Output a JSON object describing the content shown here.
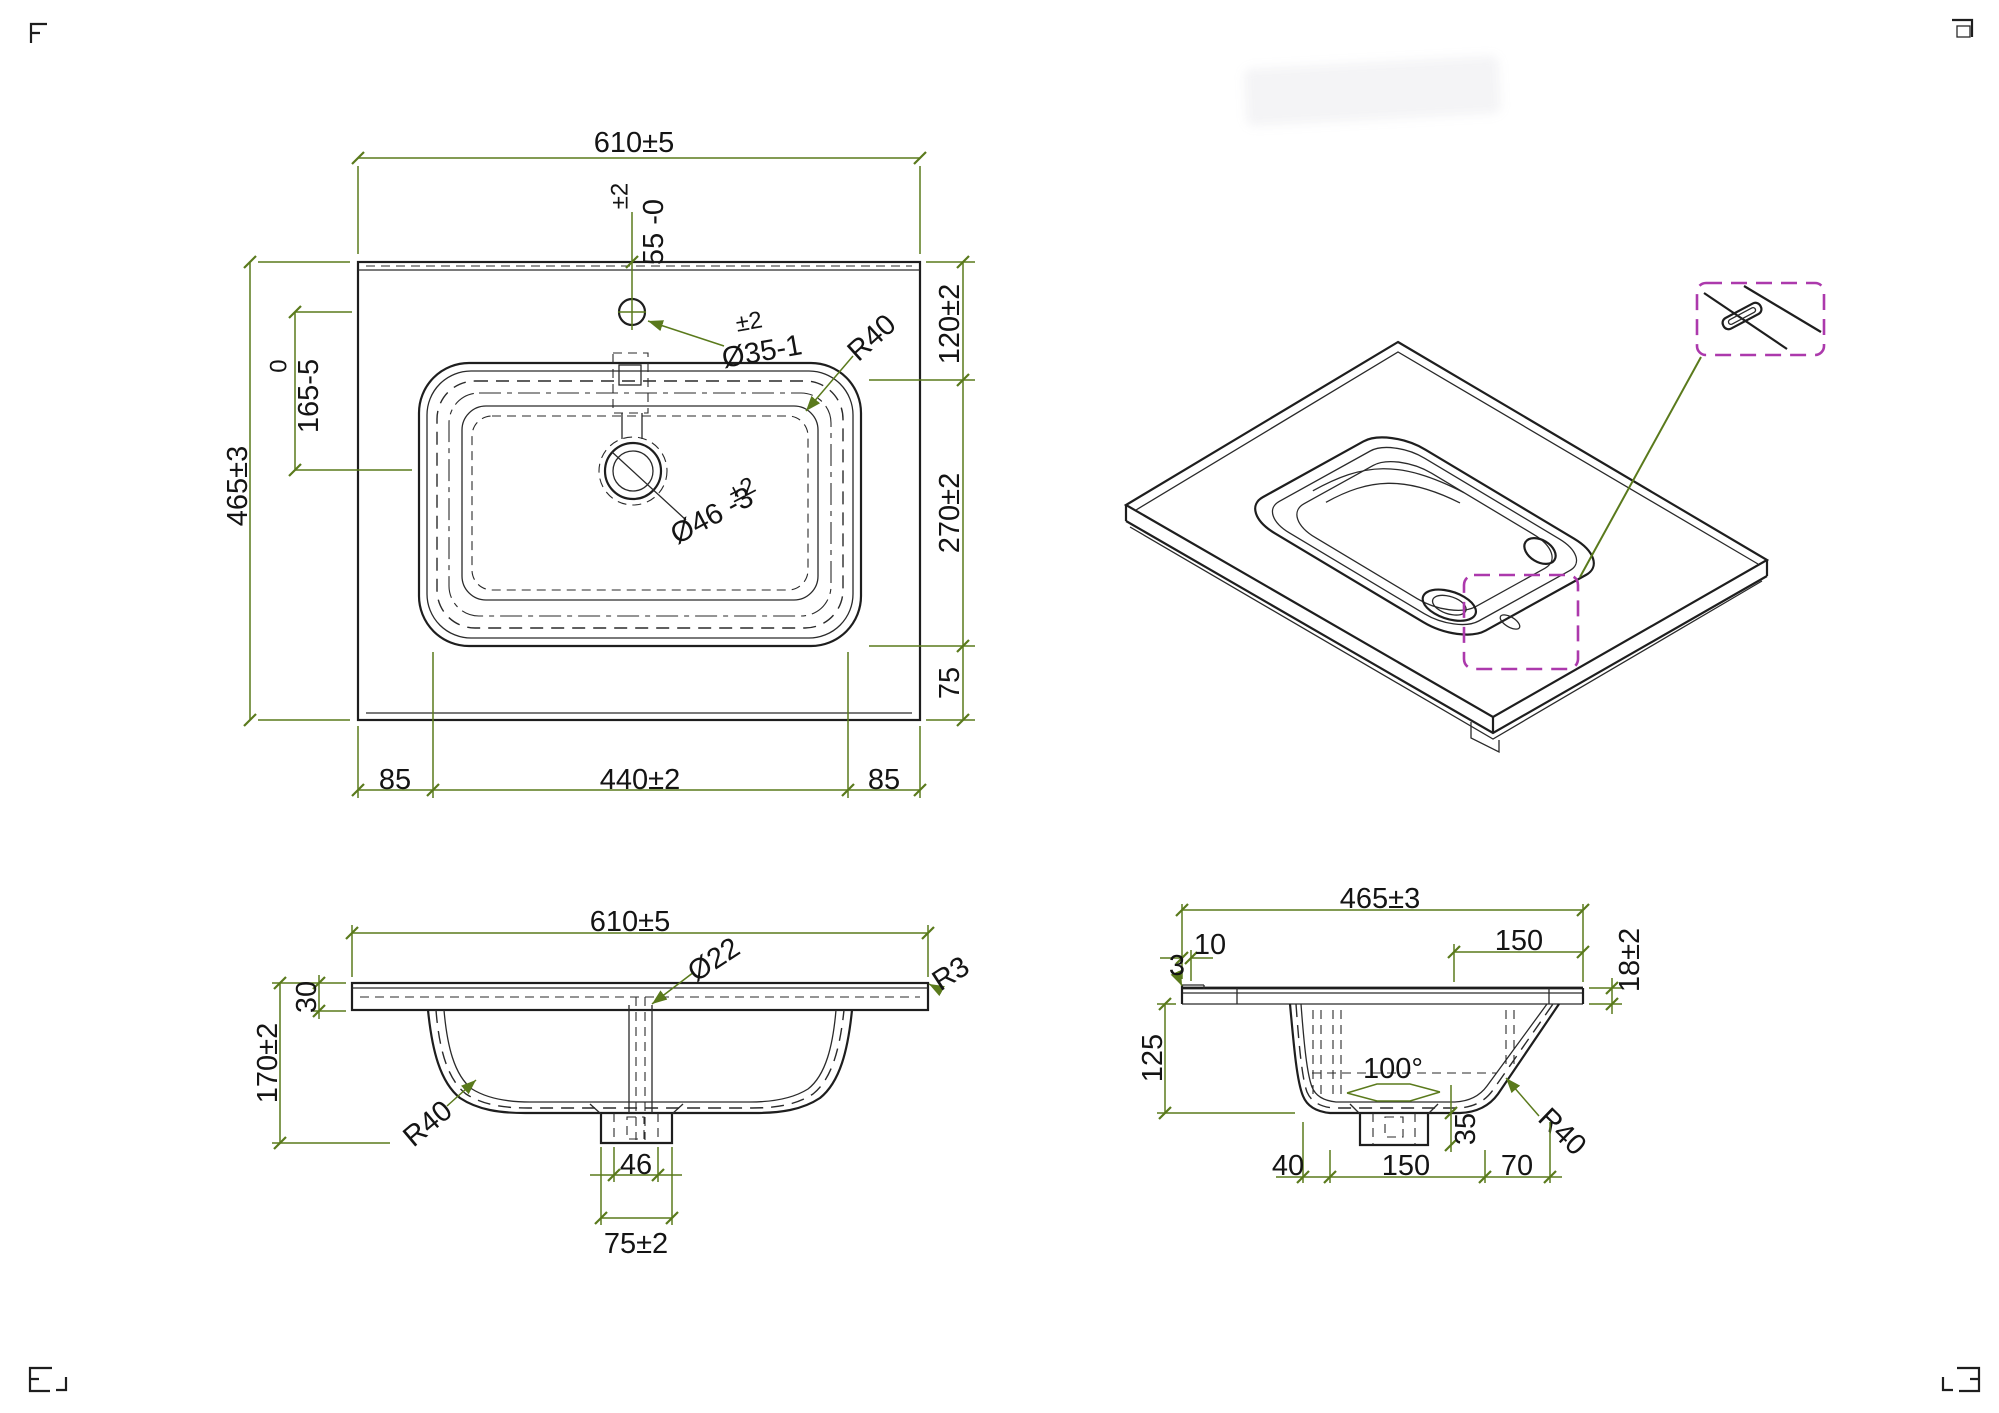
{
  "colors": {
    "line": "#1e1e1e",
    "dimension_green": "#5a7a1c",
    "text": "#141414",
    "detail_magenta": "#ac39ac"
  },
  "drawing": {
    "top_view": {
      "dims": {
        "width": "610±5",
        "faucet_tol": "±2",
        "faucet_offset": "55 -0",
        "faucet_hole_tol": "±2",
        "faucet_hole_dia": "Ø35-1",
        "corner_radius": "R40",
        "basin_tol": "0",
        "basin_offset": "165-5",
        "depth": "465±3",
        "edge_to_basin": "120±2",
        "basin_span": "270±2",
        "basin_to_edge": "75",
        "drain_tol": "±2",
        "drain_dia": "Ø46 -3",
        "margin_left": "85",
        "basin_width": "440±2",
        "margin_right": "85"
      }
    },
    "front_view": {
      "dims": {
        "width": "610±5",
        "overflow_dia": "Ø22",
        "edge_radius": "R3",
        "slab_thickness": "30",
        "total_height": "170±2",
        "bowl_radius": "R40",
        "drain_width": "46",
        "boss_width": "75±2"
      }
    },
    "side_view": {
      "dims": {
        "depth": "465±3",
        "front_lip": "10",
        "back_span": "150",
        "rim_height": "18±2",
        "lip_height": "3",
        "bowl_depth": "125",
        "wall_angle": "100°",
        "boss_height": "35",
        "bowl_radius": "R40",
        "bottom_front": "40",
        "bottom_center": "150",
        "bottom_back": "70"
      }
    }
  }
}
